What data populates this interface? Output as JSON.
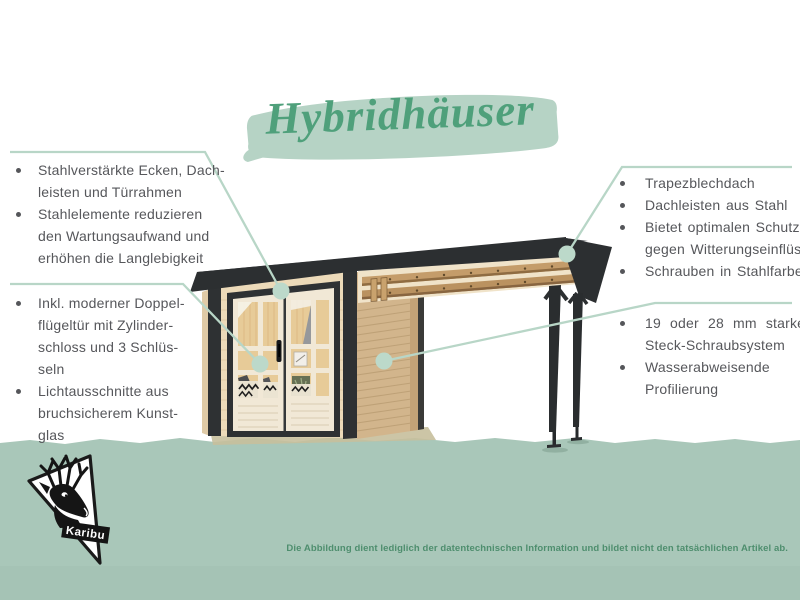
{
  "title": {
    "text": "Hybridhäuser"
  },
  "brand": {
    "logo_text": "Karibu"
  },
  "footer": {
    "disclaimer": "Die Abbildung dient lediglich der datentechnischen Information und bildet nicht den tatsächlichen Artikel ab."
  },
  "colors": {
    "accent_green": "#4fa07b",
    "brush_green": "#b6d3c5",
    "band_green": "#a9c7b9",
    "callout_line_green": "#b8d6c7",
    "text_gray": "#56575b",
    "disclaimer_green": "#4e8e6e",
    "roof_anthracite": "#2c2f31",
    "wood_front": "#ecdab9",
    "wood_side": "#d2b58c"
  },
  "callouts": {
    "top_left": {
      "rows": [
        {
          "bullet": true,
          "text": "Stahlverstärkte Ecken, Dach-"
        },
        {
          "bullet": false,
          "text": "leisten und Türrahmen"
        },
        {
          "bullet": true,
          "text": "Stahlelemente reduzieren"
        },
        {
          "bullet": false,
          "text": "den Wartungsaufwand und"
        },
        {
          "bullet": false,
          "text": "erhöhen die Langlebigkeit"
        }
      ]
    },
    "bottom_left": {
      "rows": [
        {
          "bullet": true,
          "text": "Inkl. moderner Doppel-"
        },
        {
          "bullet": false,
          "text": "flügeltür mit Zylinder-"
        },
        {
          "bullet": false,
          "text": "schloss und 3 Schlüs-"
        },
        {
          "bullet": false,
          "text": "seln"
        },
        {
          "bullet": true,
          "text": "Lichtausschnitte aus"
        },
        {
          "bullet": false,
          "text": "bruchsicherem Kunst-"
        },
        {
          "bullet": false,
          "text": "glas"
        }
      ]
    },
    "top_right": {
      "rows": [
        {
          "bullet": true,
          "text": "Trapezblechdach"
        },
        {
          "bullet": true,
          "text": "Dachleisten aus Stahl"
        },
        {
          "bullet": true,
          "text": "Bietet optimalen Schutz"
        },
        {
          "bullet": false,
          "text": "gegen Witterungseinflüsse"
        },
        {
          "bullet": true,
          "text": "Schrauben in Stahlfarbe"
        }
      ]
    },
    "bottom_right": {
      "rows": [
        {
          "bullet": true,
          "text": "19 oder 28 mm starkes"
        },
        {
          "bullet": false,
          "text": "Steck-Schraubsystem"
        },
        {
          "bullet": true,
          "text": "Wasserabweisende"
        },
        {
          "bullet": false,
          "text": "Profilierung"
        }
      ]
    }
  }
}
